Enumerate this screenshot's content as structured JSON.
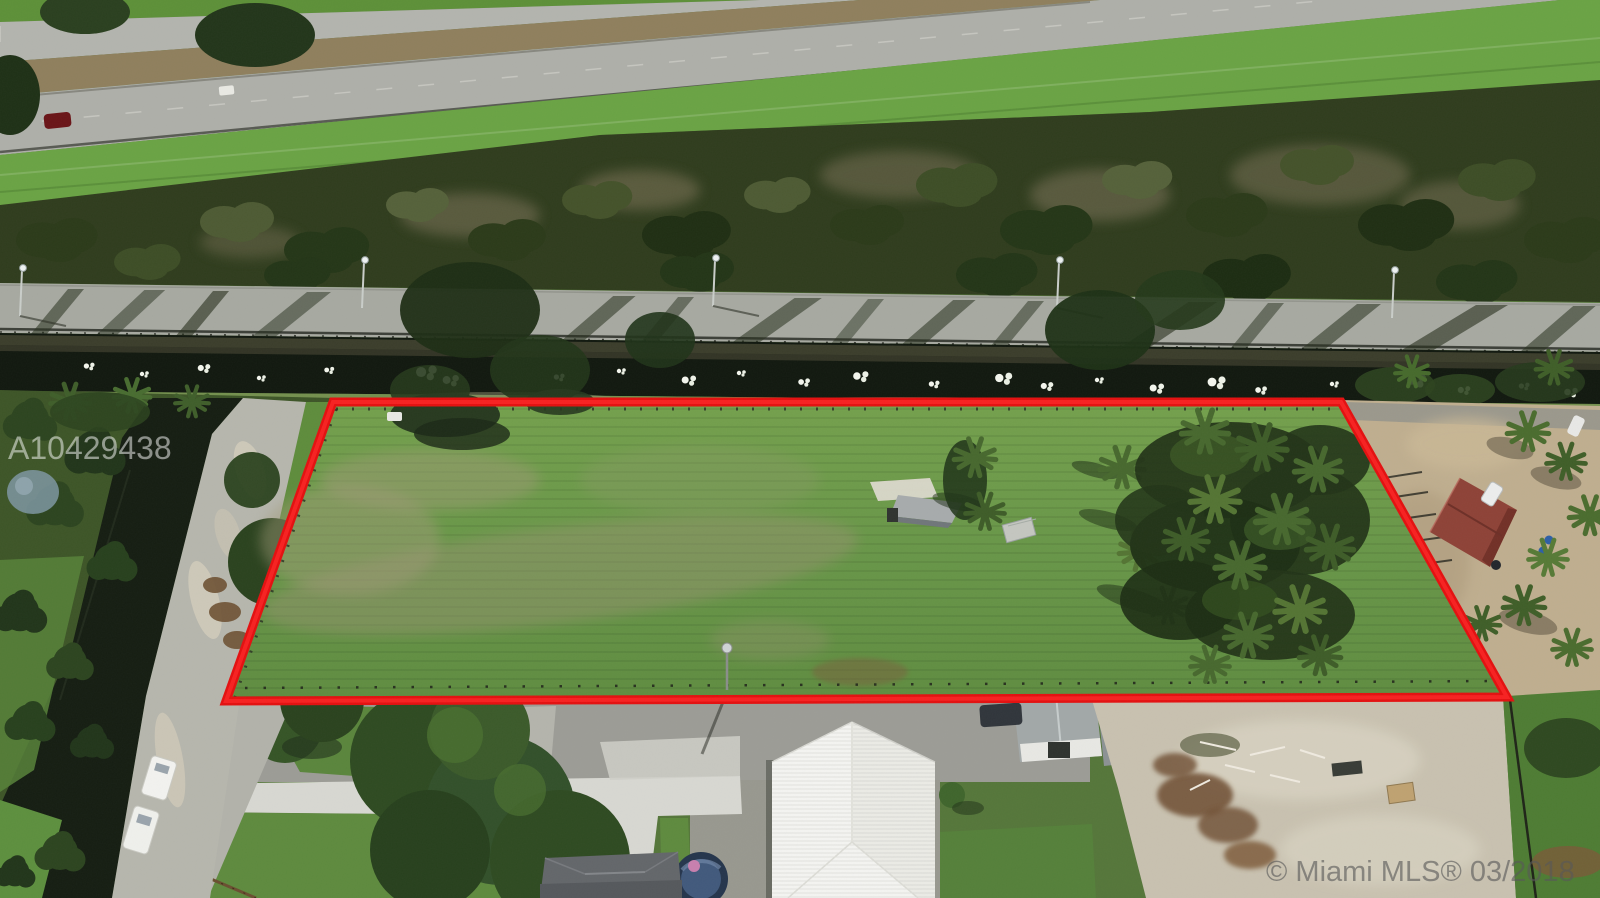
{
  "image": {
    "kind": "aerial-drone-photo",
    "description": "Aerial real-estate photo of a vacant fenced parcel outlined in red, bounded by a canal and levee road beside a highway; houses, driveways and a cleared sandy lot sit below the parcel and a red-roofed stable lot to the right.",
    "watermarks": {
      "mls_number": "A10429438",
      "copyright": "© Miami MLS® 03/2018"
    }
  },
  "colors": {
    "boundary_red": "#e41010",
    "boundary_red_core": "#ff2a2a",
    "field_green": "#6b9747",
    "canal_dark": "#11180f",
    "highway_gray": "#b3b4ae",
    "median_brown": "#8f7f5d",
    "sand_tan": "#c8c1b0",
    "white_roof": "#f4f4f1",
    "red_roof": "#8e4237",
    "watermark_white": "rgba(255,255,255,0.5)",
    "watermark_gray": "rgba(88,88,88,0.62)"
  }
}
